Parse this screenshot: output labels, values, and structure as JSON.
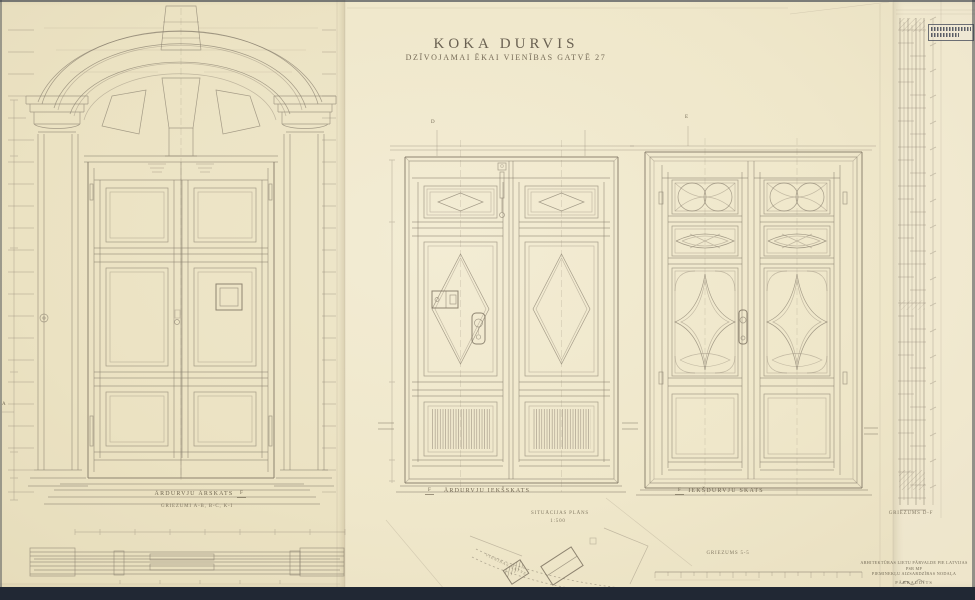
{
  "title": {
    "main": "KOKA DURVIS",
    "subtitle": "DZĪVOJAMAI ĒKAI VIENĪBAS GATVĒ 27"
  },
  "drawings": {
    "portal": {
      "label": "ĀRDURVJU ĀRSKATS",
      "sections_label": "GRIEZUMI A-B, B-C, K-I"
    },
    "exterior_inner_view": {
      "label": "ĀRDURVJU IEKŠSKATS"
    },
    "interior_view": {
      "label": "IEKŠDURVJU SKATS"
    },
    "vertical_section": {
      "label": "GRIEZUMS D-F"
    },
    "horizontal_section": {
      "label": "GRIEZUMS 5-5"
    },
    "site_plan": {
      "label": "SITUĀCIJAS PLĀNS",
      "scale": "1:500",
      "street": "VIENĪBAS GATVE"
    }
  },
  "markers": {
    "a": "A",
    "d": "D",
    "e": "E",
    "f": "F"
  },
  "stamp_block": {
    "line1": "ARHITEKTŪRAS LIETU PĀRVALDE PIE LATVIJAS PSR MP",
    "line2": "PIEMINEKĻU AIZSARDZĪBAS NODAĻA",
    "line3": "PĀRBAUDĪTS"
  },
  "colors": {
    "paper": "#efe7cb",
    "ink": "#8b8170",
    "title_ink": "#6a6152",
    "scanner_bed": "#212834"
  }
}
